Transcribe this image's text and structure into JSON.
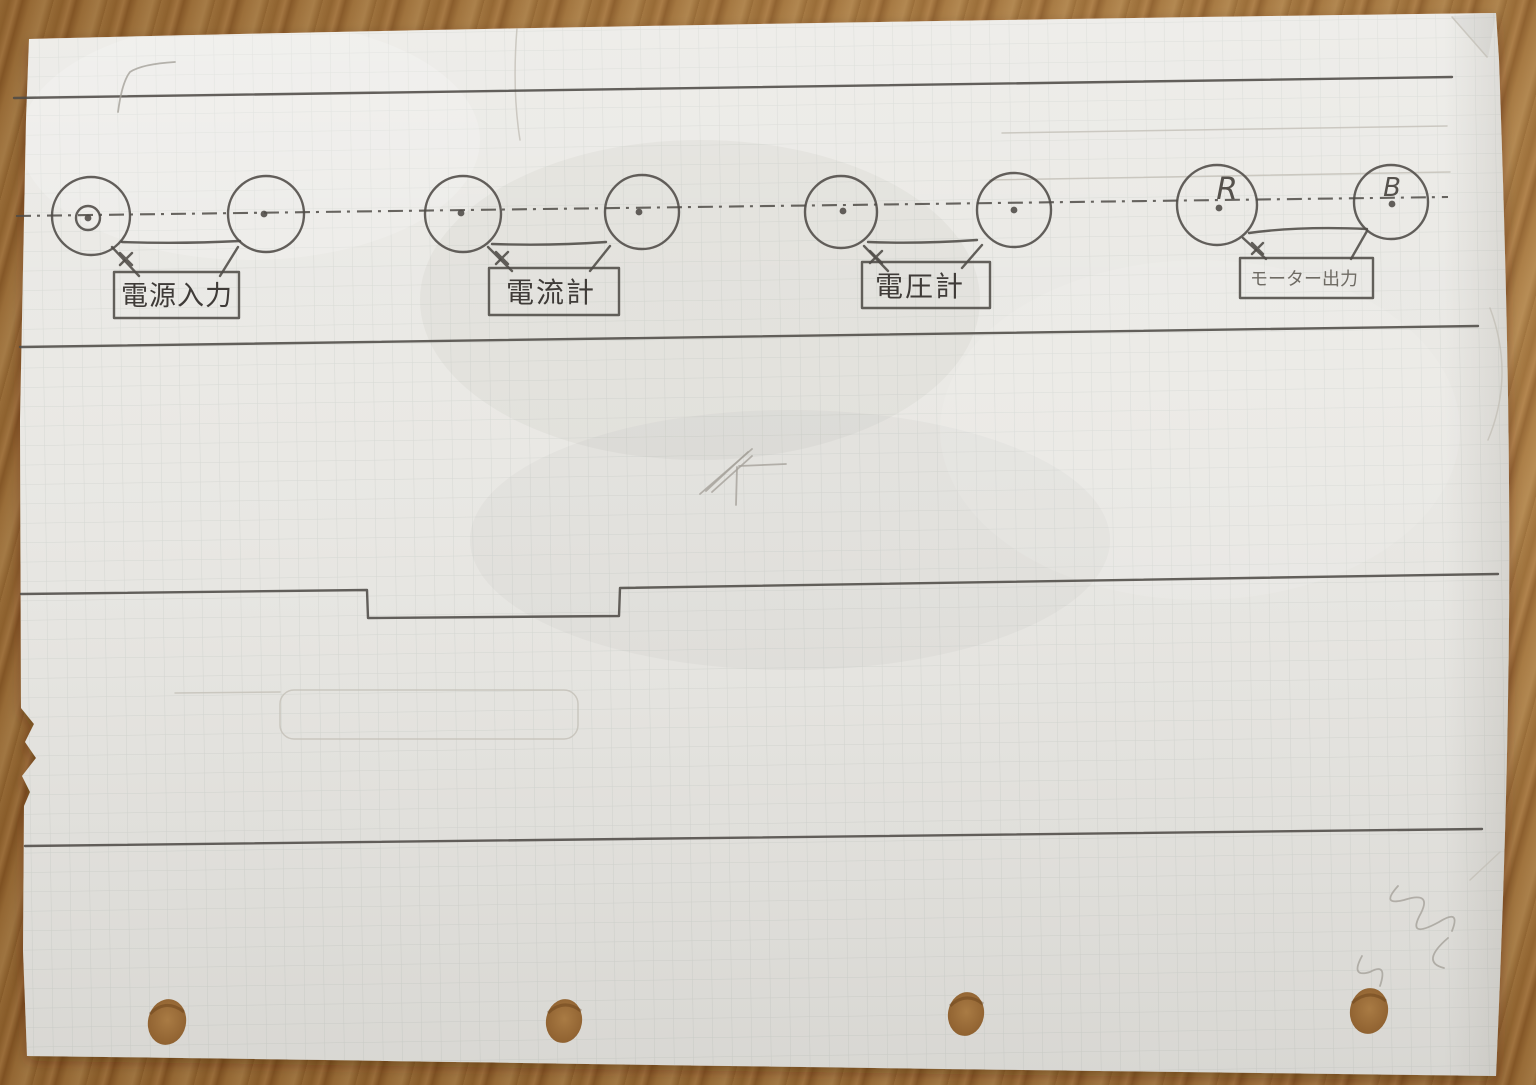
{
  "diagram": {
    "connectors": [
      {
        "id": "power-input",
        "label": "電源入力"
      },
      {
        "id": "ammeter",
        "label": "電流計"
      },
      {
        "id": "voltmeter",
        "label": "電圧計"
      },
      {
        "id": "motor-output",
        "label": "モーター出力"
      }
    ],
    "terminal_marks": {
      "r": "R",
      "b": "B"
    },
    "colors": {
      "pencil": "#4f4b47",
      "pencil_light": "#a5a19a",
      "paper": "#eae9e5",
      "grid_line": "#c7cbc6",
      "wood": "#a5733c"
    }
  }
}
